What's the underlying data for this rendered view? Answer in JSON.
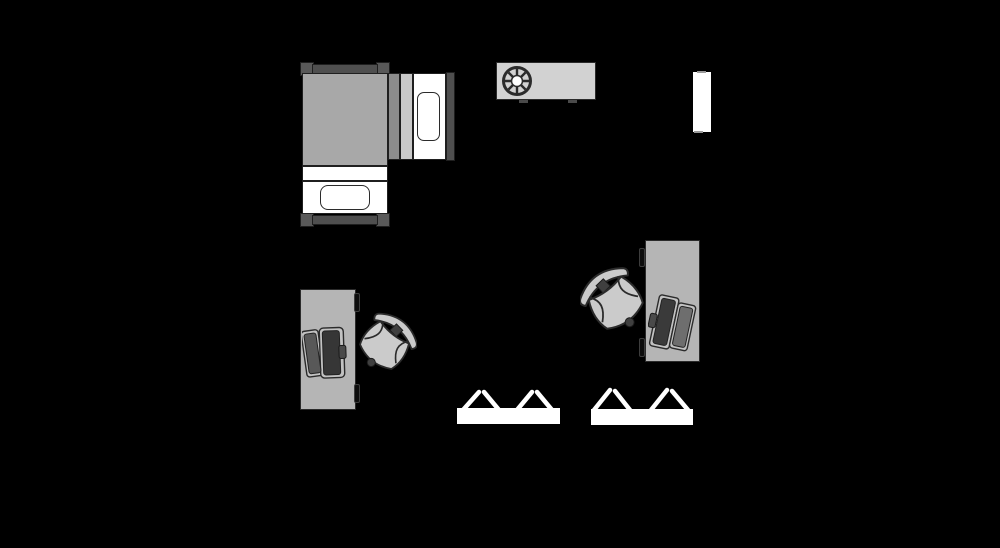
{
  "scene": {
    "kind": "floor-plan",
    "background": "#000000",
    "objects": [
      {
        "id": "bed",
        "label": "bed with corner posts and side cot"
      },
      {
        "id": "sideboard",
        "label": "sideboard with fan wheel"
      },
      {
        "id": "door-panel",
        "label": "door panel"
      },
      {
        "id": "desk-left",
        "label": "desk with open laptop"
      },
      {
        "id": "chair-left",
        "label": "swivel office chair"
      },
      {
        "id": "desk-right",
        "label": "desk with open laptop"
      },
      {
        "id": "chair-right",
        "label": "swivel office chair"
      },
      {
        "id": "trestle-table-1",
        "label": "trestle table"
      },
      {
        "id": "trestle-table-2",
        "label": "trestle table"
      }
    ],
    "palette": {
      "background": "#000000",
      "outline": "#2b2b2b",
      "mattress": "#a8a8a8",
      "frame_dark": "#4f4f4f",
      "post": "#595959",
      "strip_dark": "#8c8c8c",
      "strip_light": "#c9c9c9",
      "desk": "#b5b5b5",
      "chair": "#cbcbcb",
      "sideboard": "#d2d2d2",
      "laptop_screen": "#3a3a3a",
      "laptop_deck": "#6e6e6e",
      "white": "#ffffff"
    }
  }
}
